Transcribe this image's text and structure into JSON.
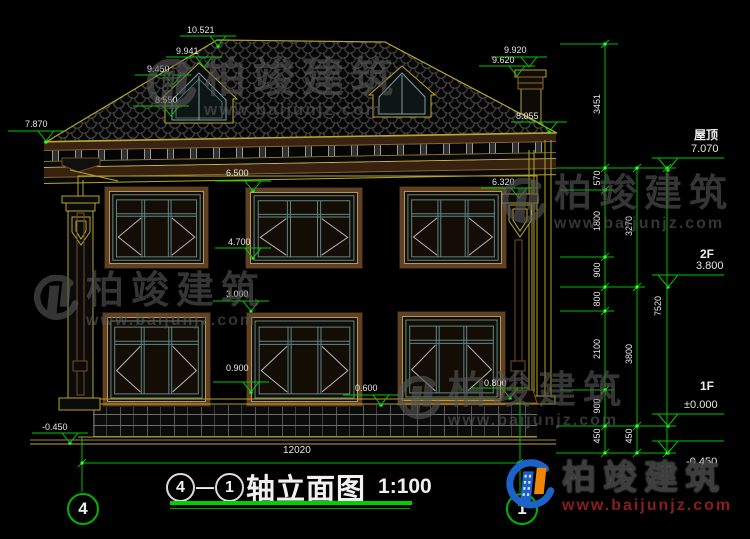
{
  "drawing": {
    "axis_left": "4",
    "axis_right": "1",
    "title_dash": "—",
    "title_text": "轴立面图",
    "title_scale": "1:100",
    "total_width_dim": "12020"
  },
  "elevations": {
    "ridge": "10.521",
    "slope_upper": "9.941",
    "slope_mid": "9.450",
    "slope_lower": "8.550",
    "eave_left": "7.870",
    "chimney_top": "9.920",
    "chimney_cap": "9.620",
    "eave_right": "8.055",
    "win2f_top": "6.500",
    "corbel_right": "6.320",
    "win2f_sill": "4.700",
    "win1f_top": "3.000",
    "win1f_sill": "0.900",
    "plinth_band": "0.600",
    "downspout_shoe": "0.800",
    "ground_left": "-0.450"
  },
  "levels_panel": {
    "roof_label": "屋顶",
    "roof_value": "7.070",
    "floor2_label": "2F",
    "floor2_value": "3.800",
    "floor1_label": "1F",
    "floor1_value": "±0.000",
    "ground_value": "-0.450",
    "chain_inner": [
      "3451",
      "570",
      "1800",
      "900",
      "800",
      "2100",
      "900",
      "450"
    ],
    "chain_mid": [
      "3270",
      "3800",
      "450"
    ],
    "chain_outer": [
      "7520"
    ]
  },
  "watermark": {
    "brand": "柏竣建筑",
    "url": "www.baijunjz.com"
  }
}
